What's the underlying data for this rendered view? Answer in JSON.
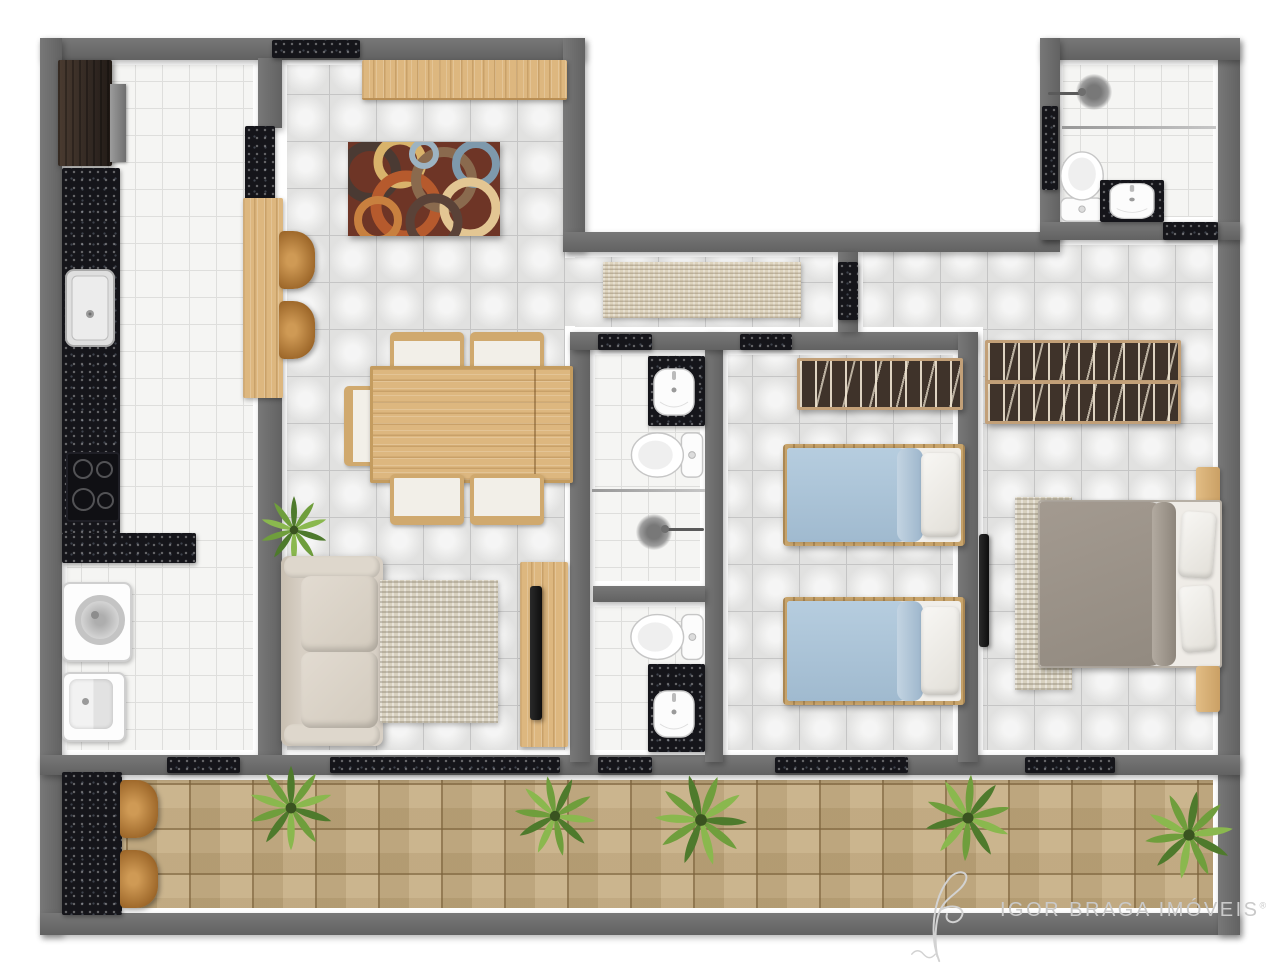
{
  "watermark": {
    "text": "IGOR BRAGA IMÓVEIS",
    "registered_mark": "®",
    "logo": "signature-flourish",
    "color": "#c9c9c9"
  },
  "palette": {
    "background": "#ffffff",
    "wall": "#6d6d6d",
    "wall_lining": "#ffffff",
    "granite_black": "#15151a",
    "wood_light": "#ddb77f",
    "stool_wood": "#a06a2c",
    "tile_small_white": "#f5f5f3",
    "tile_large_gray": "#e9e9e8",
    "balcony_paver": "#c4aa7d",
    "bed_blanket_blue": "#a9c3d8",
    "bed_blanket_taupe": "#9a9189",
    "sofa_cream": "#d7cfc4",
    "wardrobe_brown": "#3f332a",
    "plant_green": "#6f9e3c",
    "rug_circles_base": "#6e3526"
  },
  "plan": {
    "type": "apartment-floor-plan",
    "rooms": [
      {
        "name": "kitchen",
        "fixtures": [
          "refrigerator",
          "granite-counter-l-shape",
          "sink",
          "cooktop",
          "breakfast-bar",
          "bar-stool",
          "bar-stool"
        ]
      },
      {
        "name": "laundry-service-area",
        "fixtures": [
          "washing-machine",
          "laundry-tank",
          "granite-shelf"
        ]
      },
      {
        "name": "living-dining-room",
        "fixtures": [
          "sideboard",
          "circle-pattern-rug",
          "dining-table",
          "dining-chair",
          "dining-chair",
          "dining-chair",
          "dining-chair",
          "dining-chair",
          "sofa",
          "area-rug",
          "tv-console",
          "tv",
          "potted-plant"
        ]
      },
      {
        "name": "hallway",
        "fixtures": [
          "runner-rug"
        ]
      },
      {
        "name": "bathroom-1",
        "fixtures": [
          "granite-vanity",
          "wash-basin",
          "toilet",
          "glass-partition",
          "shower-drain",
          "shower-arm"
        ]
      },
      {
        "name": "bathroom-2",
        "fixtures": [
          "toilet",
          "granite-vanity",
          "wash-basin"
        ]
      },
      {
        "name": "bedroom-2",
        "fixtures": [
          "wardrobe",
          "single-bed",
          "single-bed"
        ]
      },
      {
        "name": "master-bedroom",
        "fixtures": [
          "double-wardrobe",
          "double-bed",
          "nightstand",
          "nightstand",
          "area-rug",
          "wall-tv"
        ]
      },
      {
        "name": "service-bathroom",
        "fixtures": [
          "shower-drain",
          "shower-arm",
          "glass-partition",
          "toilet",
          "granite-vanity",
          "wash-basin",
          "window"
        ]
      },
      {
        "name": "balcony",
        "fixtures": [
          "granite-bar-counter",
          "bar-stool",
          "bar-stool",
          "plant",
          "plant",
          "plant",
          "plant",
          "plant"
        ]
      }
    ],
    "doors_thresholds": [
      "bathroom-1-door",
      "bedroom-2-door",
      "bathroom-2-door",
      "living-balcony-sliding-door",
      "service-balcony-door",
      "bedroom-2-balcony-sliding-door",
      "master-balcony-door",
      "master-bedroom-door",
      "service-bathroom-door",
      "service-bathroom-window",
      "living-room-window"
    ]
  }
}
